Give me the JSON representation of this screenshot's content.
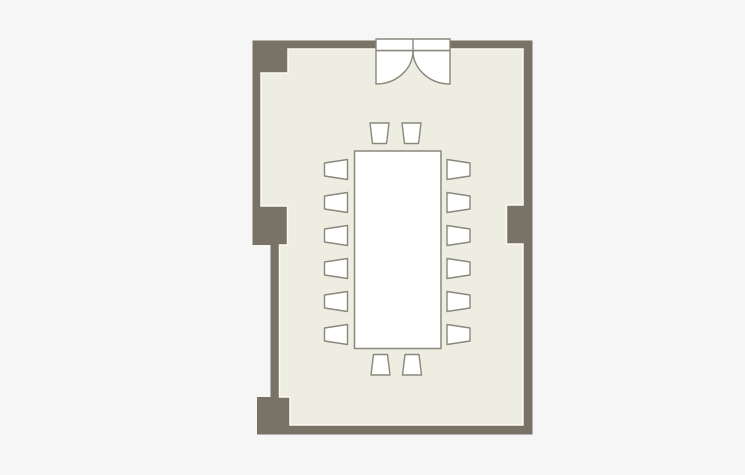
{
  "floorplan": {
    "canvas": {
      "width": 745,
      "height": 475,
      "background": "#f6f6f6"
    },
    "colors": {
      "wall": "#787366",
      "floor": "#eeede2",
      "floor_edge": "#fbfaf3",
      "furniture_fill": "#ffffff",
      "furniture_stroke": "#8a877b"
    },
    "summary": {
      "room": "meeting-room",
      "chair_count": 16,
      "door": "double-swing-door",
      "tables": 1
    },
    "room": {
      "interior_polygon": "288,49 523,49 523,205 506.5,205 506.5,244 523,244 523,425 290,425 290,397 279.5,397 279.5,245 287.5,245 287.5,206 261,206 261,73 288,73"
    },
    "walls": [
      {
        "name": "wall-top",
        "x": 252.5,
        "y": 40.5,
        "w": 280,
        "h": 8.5
      },
      {
        "name": "wall-corner-top-left",
        "x": 252.5,
        "y": 40.5,
        "w": 35.5,
        "h": 32.5
      },
      {
        "name": "wall-left-upper",
        "x": 252.5,
        "y": 73,
        "w": 8.5,
        "h": 133
      },
      {
        "name": "pillar-left",
        "x": 252.5,
        "y": 205,
        "w": 35,
        "h": 40
      },
      {
        "name": "wall-left-lower",
        "x": 270.5,
        "y": 245,
        "w": 9,
        "h": 152
      },
      {
        "name": "wall-corner-bottom-left",
        "x": 257,
        "y": 397,
        "w": 33,
        "h": 37.5
      },
      {
        "name": "wall-bottom",
        "x": 257,
        "y": 425,
        "w": 275.5,
        "h": 9.5
      },
      {
        "name": "wall-right",
        "x": 523,
        "y": 40.5,
        "w": 9.5,
        "h": 394
      },
      {
        "name": "pillar-right",
        "x": 506.5,
        "y": 205,
        "w": 16.5,
        "h": 39
      }
    ],
    "door": {
      "frame": {
        "x": 376,
        "y": 39,
        "w": 74,
        "h": 11.5
      },
      "divider_x": 413,
      "hinge_y": 50.5,
      "left_hinge_x": 376,
      "right_hinge_x": 450,
      "leaf_rx": 37,
      "leaf_ry": 33.5,
      "swing_bottom_y": 84
    },
    "table": {
      "x": 354.5,
      "y": 151,
      "w": 86.5,
      "h": 197.5
    },
    "chair_size": {
      "side_w": 23,
      "side_h": 20,
      "end_w": 19,
      "end_h": 20.5,
      "taper_side": 3.5,
      "taper_end": 2.5
    },
    "chairs": [
      {
        "side": "top",
        "x": 370,
        "y": 123
      },
      {
        "side": "top",
        "x": 402,
        "y": 123
      },
      {
        "side": "bottom",
        "x": 371,
        "y": 354.5
      },
      {
        "side": "bottom",
        "x": 402.5,
        "y": 354.5
      },
      {
        "side": "left",
        "x": 324.5,
        "y": 159.5
      },
      {
        "side": "left",
        "x": 324.5,
        "y": 192.5
      },
      {
        "side": "left",
        "x": 324.5,
        "y": 225.5
      },
      {
        "side": "left",
        "x": 324.5,
        "y": 258.5
      },
      {
        "side": "left",
        "x": 324.5,
        "y": 291.5
      },
      {
        "side": "left",
        "x": 324.5,
        "y": 324.5
      },
      {
        "side": "right",
        "x": 447,
        "y": 159.5
      },
      {
        "side": "right",
        "x": 447,
        "y": 192.5
      },
      {
        "side": "right",
        "x": 447,
        "y": 225.5
      },
      {
        "side": "right",
        "x": 447,
        "y": 258.5
      },
      {
        "side": "right",
        "x": 447,
        "y": 291.5
      },
      {
        "side": "right",
        "x": 447,
        "y": 324.5
      }
    ]
  }
}
